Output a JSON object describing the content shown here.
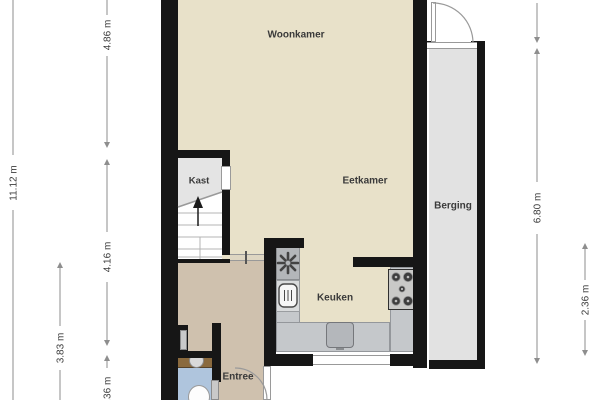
{
  "floorplan": {
    "type": "ground-floor plan, cropped top and bottom",
    "rooms": {
      "woonkamer": {
        "label": "Woonkamer"
      },
      "eetkamer": {
        "label": "Eetkamer"
      },
      "kast": {
        "label": "Kast"
      },
      "keuken": {
        "label": "Keuken"
      },
      "entree": {
        "label": "Entree"
      },
      "berging": {
        "label": "Berging"
      }
    },
    "dimensions": {
      "total_height": {
        "label": "11.12 m"
      },
      "upper_section": {
        "label": "4.86 m"
      },
      "middle_section": {
        "label": "4.16 m"
      },
      "hall_section": {
        "label": "3.83 m"
      },
      "bottom_section": {
        "label": "1.36 m"
      },
      "berging_full": {
        "label": "6.80 m"
      },
      "berging_lower": {
        "label": "2.36 m"
      }
    },
    "fixtures": {
      "stairs": "staircase with up arrow",
      "extractor_fan": "fan / boiler asterisk icon",
      "oven": "oven icon",
      "hob": "4-burner gas hob",
      "kitchen_sink": "sink basin",
      "washbasin": "round washbasin on vanity",
      "toilet": "toilet bowl",
      "doors": [
        "berging exterior door with swing arc",
        "entree door with swing arc",
        "kast door",
        "wc doors"
      ]
    },
    "colors": {
      "wall": "#161616",
      "living_floor": "#e8e1c9",
      "hall_floor": "#cfc1ae",
      "closet_floor": "#e4e4e4",
      "storage_floor": "#e2e2e2",
      "counter": "#c5c8cb",
      "toilet_floor": "#afc5dd",
      "vanity": "#8a6a3e",
      "dimension_line": "#8e8e8e",
      "label_text": "#3a3a3a"
    }
  }
}
